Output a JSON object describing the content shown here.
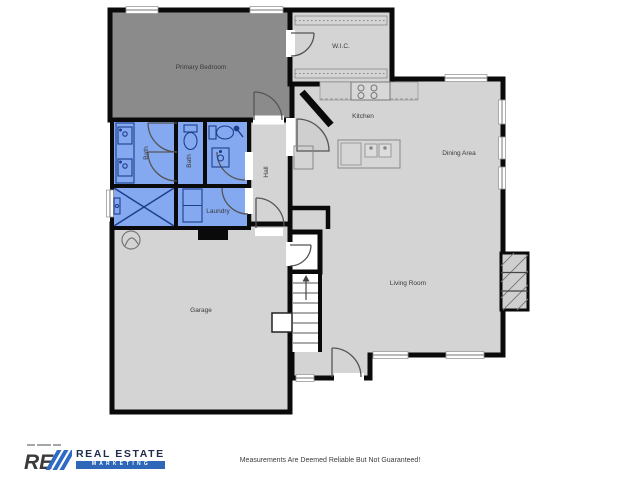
{
  "disclaimer": "Measurements Are Deemed Reliable But Not Guaranteed!",
  "logo": {
    "mark": "RE",
    "line1": "REAL ESTATE",
    "line2": "MARKETING",
    "navy": "#1e2b4d",
    "blue": "#2f6bc6"
  },
  "colors": {
    "wall": "#0a0a0a",
    "room_light": "#d4d4d4",
    "room_dark": "#8b8b8b",
    "room_wet": "#84a9f0",
    "wet_stroke": "#1f3e8c",
    "fixture": "#777777"
  },
  "rooms": {
    "primary_bedroom": {
      "label": "Primary Bedroom"
    },
    "wic": {
      "label": "W.I.C."
    },
    "kitchen": {
      "label": "Kitchen"
    },
    "dining": {
      "label": "Dining Area"
    },
    "living": {
      "label": "Living Room"
    },
    "hall": {
      "label": "Hall"
    },
    "bath_primary": {
      "label": "Bath"
    },
    "bath_hall": {
      "label": "Bath"
    },
    "laundry": {
      "label": "Laundry"
    },
    "garage": {
      "label": "Garage"
    }
  }
}
